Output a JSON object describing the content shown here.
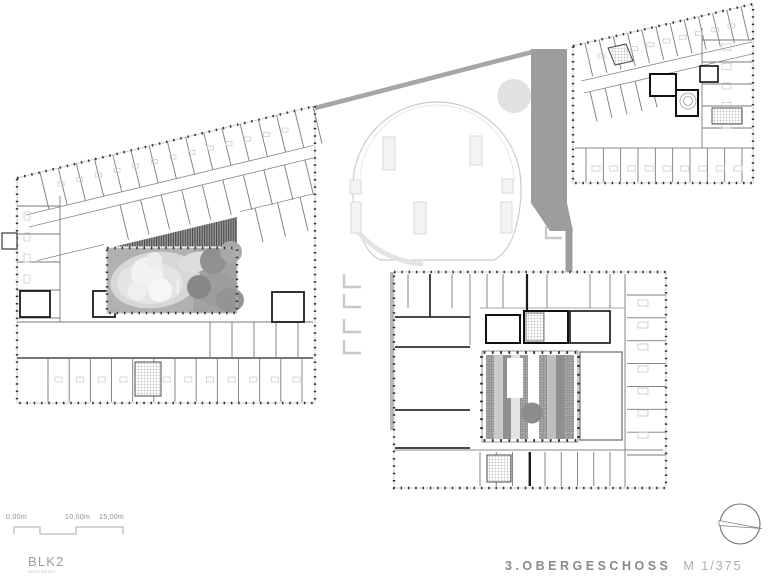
{
  "sheet": {
    "width_px": 780,
    "height_px": 581,
    "background": "#ffffff"
  },
  "title_block": {
    "floor_label": "3.OBERGESCHOSS",
    "scale_label": "M 1/375"
  },
  "logo": {
    "name": "BLK2",
    "subtitle": "Architekten"
  },
  "scale_bar": {
    "labels": [
      "0,00m",
      "10,00m",
      "15,00m"
    ]
  },
  "compass": {
    "icon": "north-arrow-icon"
  },
  "drawing": {
    "kind": "architectural-floor-plan",
    "wings": [
      "west-wing",
      "north-east-wing",
      "south-east-wing"
    ],
    "features": [
      "circular-roof-terrace",
      "roof-band",
      "west-courtyard-garden",
      "south-east-atrium"
    ]
  },
  "colors": {
    "roof_band": "#9d9d9d",
    "courtyard_fill": "#b1b1b1",
    "facade_dash": "#2e2e2e",
    "thin_wall": "#7a7a7a",
    "title_text": "#8a8a8a",
    "muted_text": "#aeaeae"
  }
}
